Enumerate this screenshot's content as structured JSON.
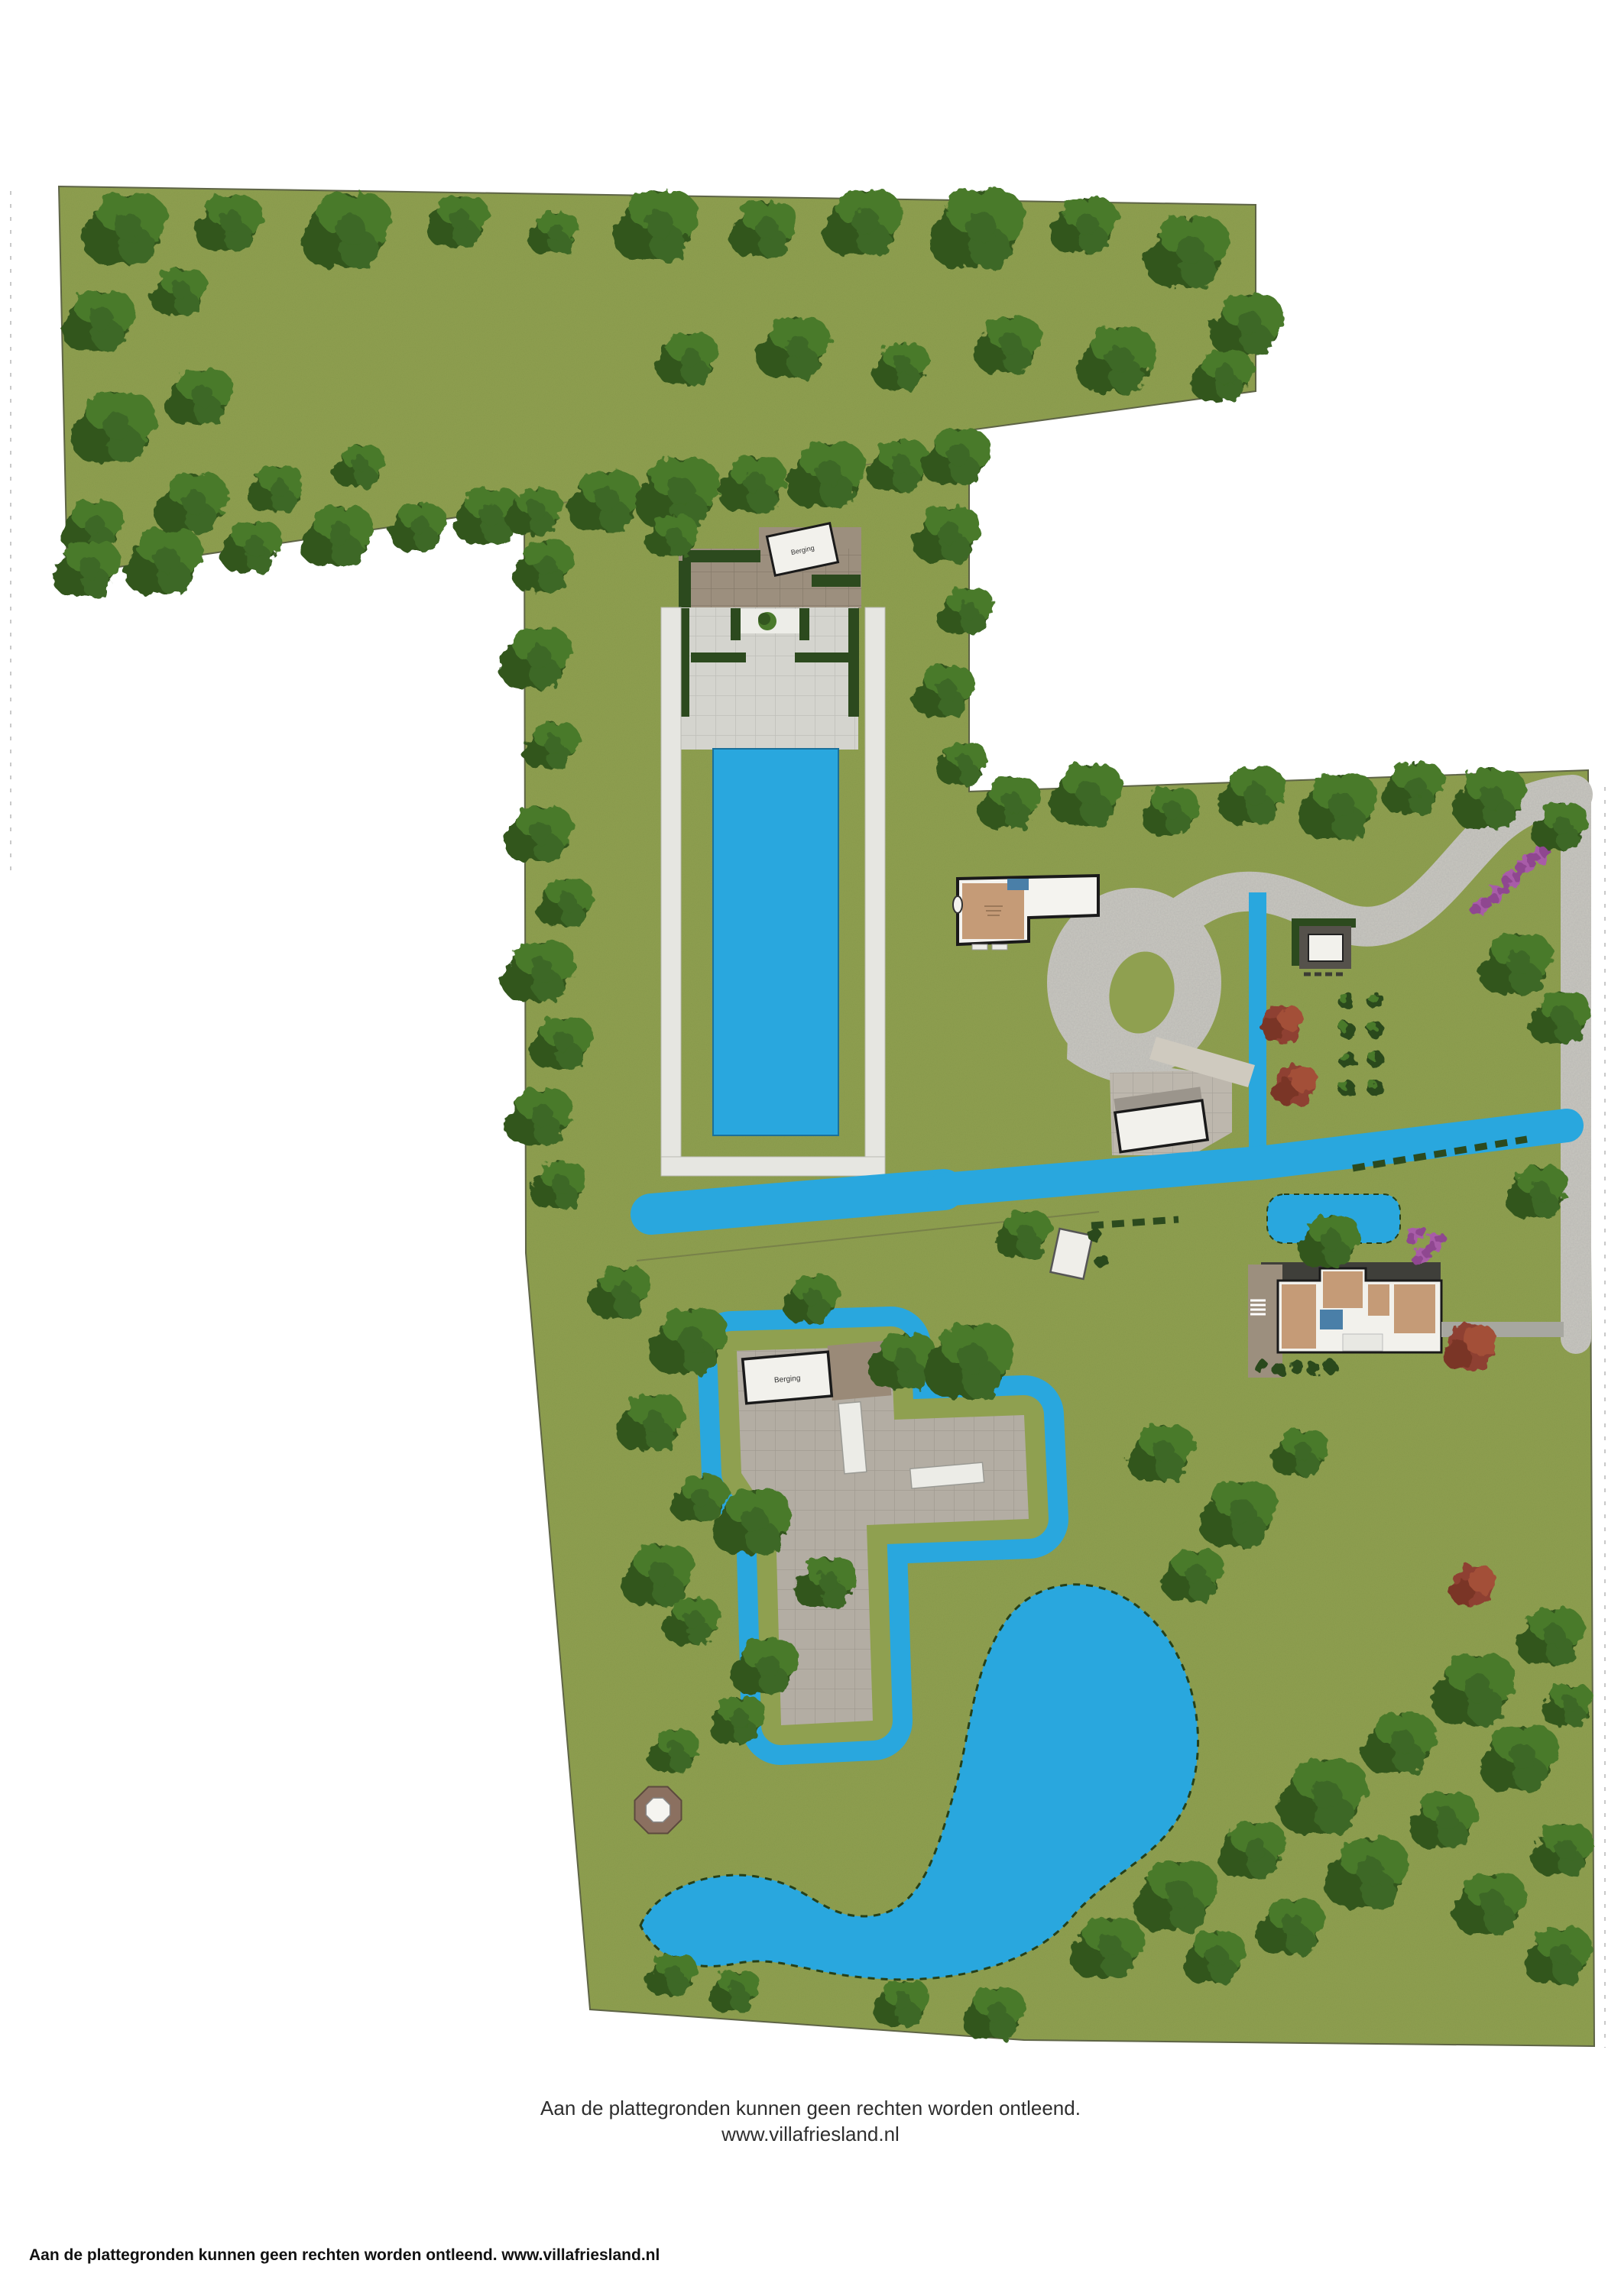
{
  "footer": {
    "line1": "Aan de plattegronden kunnen geen rechten worden ontleend.",
    "line2": "www.villafriesland.nl"
  },
  "corner_note": "Aan de plattegronden kunnen geen rechten worden ontleend. www.villafriesland.nl",
  "labels": {
    "top_shed": "Berging",
    "yard_shed": "Berging"
  },
  "colors": {
    "grass": "#8FA050",
    "tree": "#33571F",
    "tree2": "#4A7A2C",
    "tree3": "#3C6825",
    "water": "#29A7DE",
    "gravel": "#C8C7C0",
    "terrace": "#D4D4CE",
    "path_white": "#E6E6E1",
    "patio": "#9C8F7E",
    "pave_light": "#BDB7AD",
    "yard": "#B3ADA3",
    "slate": "#3F3F3A",
    "wall": "#1A1A1A",
    "room_tan": "#C59B77",
    "room_blue": "#4A7FA8",
    "hedge": "#2C4A1E",
    "purple": "#A85CA8",
    "purple2": "#8F4790",
    "autumn": "#8E4030",
    "autumn2": "#7A3426",
    "autumn3": "#A35039",
    "brown_strip": "#9A8A78",
    "octagon": "#8B7060"
  },
  "map": {
    "trees": [
      [
        165,
        300,
        1.5
      ],
      [
        300,
        292,
        1.2
      ],
      [
        455,
        302,
        1.6
      ],
      [
        600,
        290,
        1.1
      ],
      [
        725,
        305,
        0.9
      ],
      [
        860,
        296,
        1.5
      ],
      [
        1000,
        300,
        1.2
      ],
      [
        1130,
        292,
        1.4
      ],
      [
        1280,
        300,
        1.7
      ],
      [
        1420,
        296,
        1.2
      ],
      [
        1555,
        330,
        1.5
      ],
      [
        1632,
        425,
        1.3
      ],
      [
        130,
        420,
        1.3
      ],
      [
        235,
        382,
        1.0
      ],
      [
        150,
        560,
        1.5
      ],
      [
        262,
        520,
        1.2
      ],
      [
        122,
        690,
        1.1
      ],
      [
        252,
        660,
        1.3
      ],
      [
        362,
        640,
        1.0
      ],
      [
        470,
        610,
        0.9
      ],
      [
        115,
        745,
        1.2
      ],
      [
        215,
        735,
        1.4
      ],
      [
        330,
        716,
        1.1
      ],
      [
        442,
        702,
        1.3
      ],
      [
        548,
        690,
        1.0
      ],
      [
        640,
        676,
        1.2
      ],
      [
        900,
        470,
        1.1
      ],
      [
        1040,
        456,
        1.3
      ],
      [
        1180,
        480,
        1.0
      ],
      [
        1320,
        452,
        1.2
      ],
      [
        1462,
        472,
        1.4
      ],
      [
        1600,
        492,
        1.1
      ],
      [
        700,
        670,
        1.0
      ],
      [
        792,
        656,
        1.3
      ],
      [
        888,
        646,
        1.5
      ],
      [
        986,
        634,
        1.2
      ],
      [
        1082,
        622,
        1.4
      ],
      [
        1176,
        610,
        1.1
      ],
      [
        1252,
        598,
        1.2
      ],
      [
        1240,
        700,
        1.2
      ],
      [
        1264,
        800,
        1.0
      ],
      [
        1236,
        905,
        1.1
      ],
      [
        1260,
        1000,
        0.9
      ],
      [
        712,
        742,
        1.1
      ],
      [
        702,
        862,
        1.3
      ],
      [
        722,
        976,
        1.0
      ],
      [
        880,
        702,
        0.9
      ],
      [
        1322,
        1052,
        1.1
      ],
      [
        1422,
        1040,
        1.3
      ],
      [
        1532,
        1062,
        1.0
      ],
      [
        1640,
        1042,
        1.2
      ],
      [
        1752,
        1056,
        1.4
      ],
      [
        1850,
        1032,
        1.1
      ],
      [
        1950,
        1046,
        1.3
      ],
      [
        2042,
        1082,
        1.0
      ],
      [
        1985,
        1262,
        1.3
      ],
      [
        2042,
        1332,
        1.1
      ],
      [
        2012,
        1560,
        1.1
      ],
      [
        706,
        1092,
        1.2
      ],
      [
        740,
        1182,
        1.0
      ],
      [
        706,
        1272,
        1.3
      ],
      [
        736,
        1366,
        1.1
      ],
      [
        706,
        1462,
        1.2
      ],
      [
        732,
        1552,
        1.0
      ],
      [
        812,
        1692,
        1.1
      ],
      [
        902,
        1756,
        1.4
      ],
      [
        852,
        1862,
        1.2
      ],
      [
        916,
        1962,
        1.0
      ],
      [
        862,
        2062,
        1.3
      ],
      [
        1082,
        2072,
        1.1
      ],
      [
        906,
        2122,
        1.0
      ],
      [
        1002,
        2182,
        1.2
      ],
      [
        882,
        2292,
        0.9
      ],
      [
        966,
        2252,
        1.0
      ],
      [
        1062,
        1700,
        1.0
      ],
      [
        1182,
        1782,
        1.2
      ],
      [
        1340,
        1616,
        1.0
      ],
      [
        1270,
        1782,
        1.6
      ],
      [
        985,
        1992,
        1.4
      ],
      [
        1740,
        1625,
        1.1
      ],
      [
        1520,
        1902,
        1.2
      ],
      [
        1622,
        1982,
        1.4
      ],
      [
        1562,
        2062,
        1.1
      ],
      [
        1702,
        1902,
        1.0
      ],
      [
        1450,
        2550,
        1.3
      ],
      [
        1540,
        2482,
        1.5
      ],
      [
        1640,
        2422,
        1.2
      ],
      [
        1732,
        2352,
        1.6
      ],
      [
        1832,
        2282,
        1.3
      ],
      [
        1930,
        2212,
        1.5
      ],
      [
        2030,
        2142,
        1.2
      ],
      [
        1990,
        2302,
        1.4
      ],
      [
        1890,
        2382,
        1.2
      ],
      [
        1790,
        2452,
        1.5
      ],
      [
        1690,
        2522,
        1.2
      ],
      [
        2046,
        2422,
        1.1
      ],
      [
        1950,
        2492,
        1.3
      ],
      [
        1590,
        2562,
        1.1
      ],
      [
        2052,
        2232,
        0.9
      ],
      [
        2040,
        2560,
        1.2
      ],
      [
        880,
        2585,
        0.9
      ],
      [
        962,
        2606,
        0.9
      ],
      [
        1180,
        2622,
        1.0
      ],
      [
        1302,
        2636,
        1.1
      ]
    ],
    "autumn_trees": [
      [
        1678,
        1340,
        1.0
      ],
      [
        1694,
        1420,
        1.1
      ],
      [
        1923,
        1763,
        1.3
      ],
      [
        1927,
        2075,
        1.1
      ]
    ],
    "purple_shrubs": [
      [
        1960,
        1170
      ],
      [
        1978,
        1150
      ],
      [
        1997,
        1131
      ],
      [
        2014,
        1118
      ],
      [
        1938,
        1186
      ],
      [
        1853,
        1616
      ],
      [
        1878,
        1625
      ],
      [
        1861,
        1643
      ]
    ],
    "veg_bushes": [
      [
        1762,
        1310
      ],
      [
        1800,
        1310
      ],
      [
        1762,
        1348
      ],
      [
        1800,
        1348
      ],
      [
        1762,
        1386
      ],
      [
        1800,
        1386
      ],
      [
        1762,
        1424
      ],
      [
        1800,
        1424
      ]
    ],
    "small_shrubs": [
      [
        1650,
        1788
      ],
      [
        1673,
        1792
      ],
      [
        1696,
        1788
      ],
      [
        1719,
        1792
      ],
      [
        1742,
        1790
      ],
      [
        1432,
        1616
      ],
      [
        1441,
        1650
      ]
    ]
  }
}
